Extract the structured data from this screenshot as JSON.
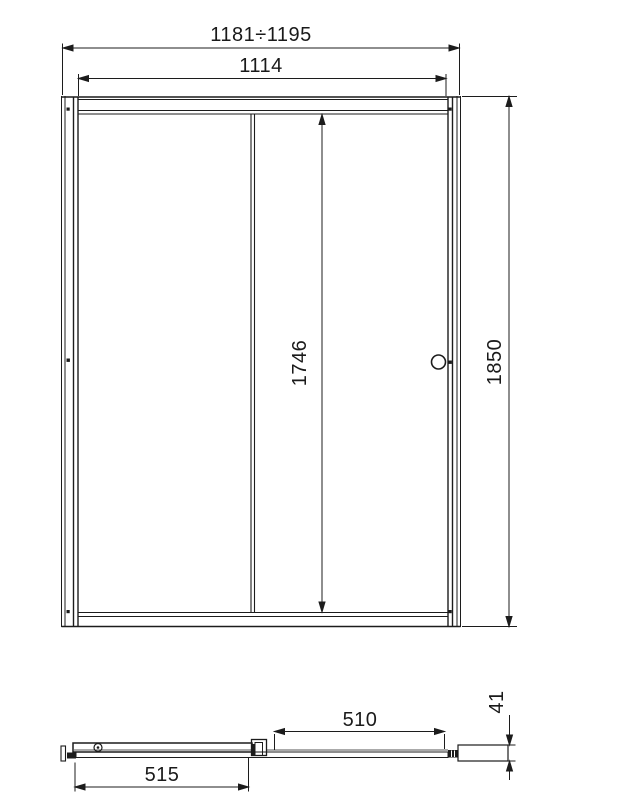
{
  "figure": {
    "background": "#ffffff",
    "line_color": "#1c1c1c",
    "front_view": {
      "dim_overall_width": "1181÷1195",
      "dim_inner_width": "1114",
      "dim_glass_height": "1746",
      "dim_overall_height": "1850"
    },
    "plan_view": {
      "dim_fixed_panel": "510",
      "dim_door_panel": "515",
      "dim_profile_depth": "41"
    }
  }
}
